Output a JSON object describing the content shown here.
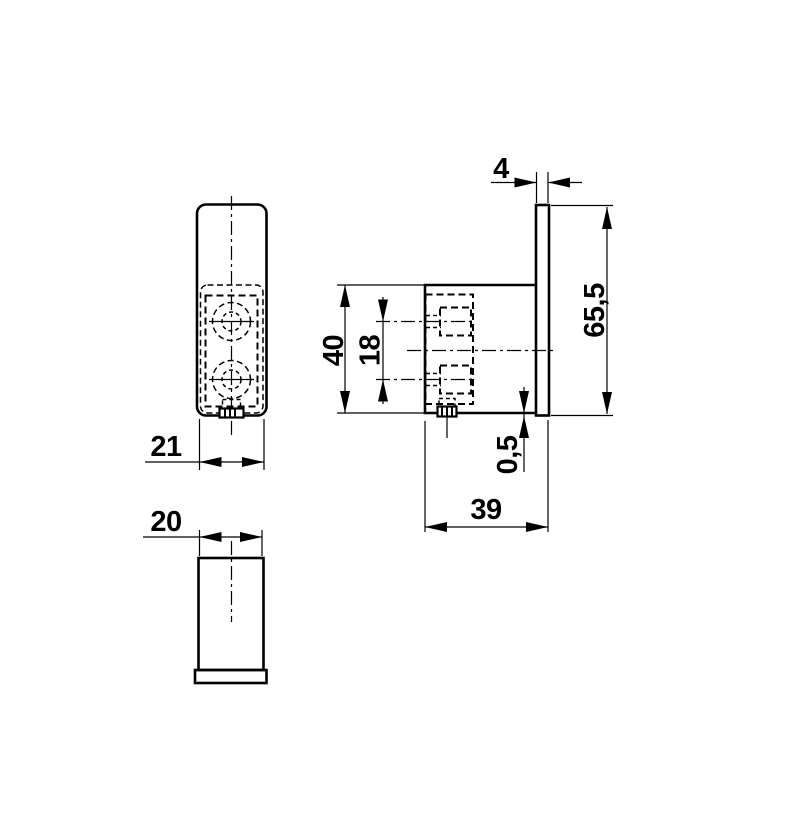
{
  "colors": {
    "background": "#ffffff",
    "line": "#000000"
  },
  "dimensions": {
    "front_width": "21",
    "body_width": "20",
    "plate_thickness": "4",
    "plate_height": "65,5",
    "body_height": "40",
    "hole_spacing": "18",
    "bottom_offset": "0,5",
    "total_depth": "39"
  }
}
